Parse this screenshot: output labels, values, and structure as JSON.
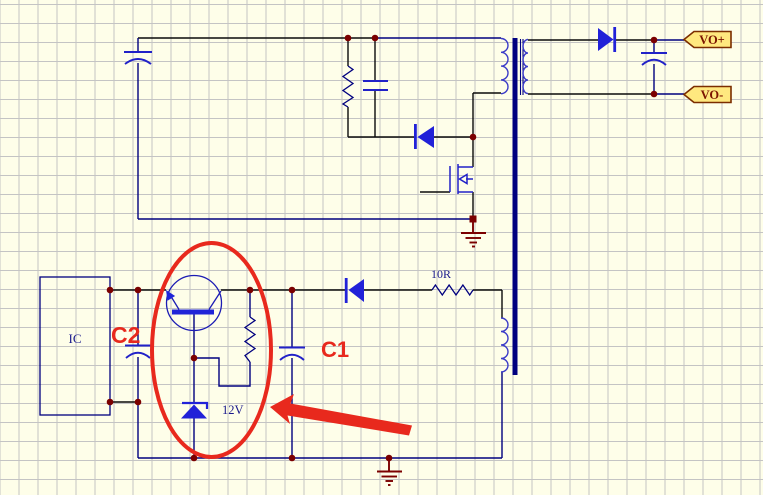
{
  "window": {
    "width": 763,
    "height": 495
  },
  "palette": {
    "background": "#FEFEE9",
    "grid": "#C4C4C4",
    "wire_navy": "#00007F",
    "pin_black": "#0A0A0A",
    "component_stroke": "#2121C8",
    "component_fill": "#2121D8",
    "coil_blue": "#3A3AC8",
    "junction_maroon": "#7B0000",
    "annotation_red": "#E8291D",
    "port_fill": "#FFE87F",
    "port_border": "#7B2D00",
    "port_text": "#7B1400",
    "schematic_text": "#1A1A8C"
  },
  "labels": {
    "ic": "IC",
    "aux_resistor": "10R",
    "zener_voltage": "12V",
    "annotation_c1": "C1",
    "annotation_c2": "C2",
    "port_positive": "VO+",
    "port_negative": "VO-"
  }
}
